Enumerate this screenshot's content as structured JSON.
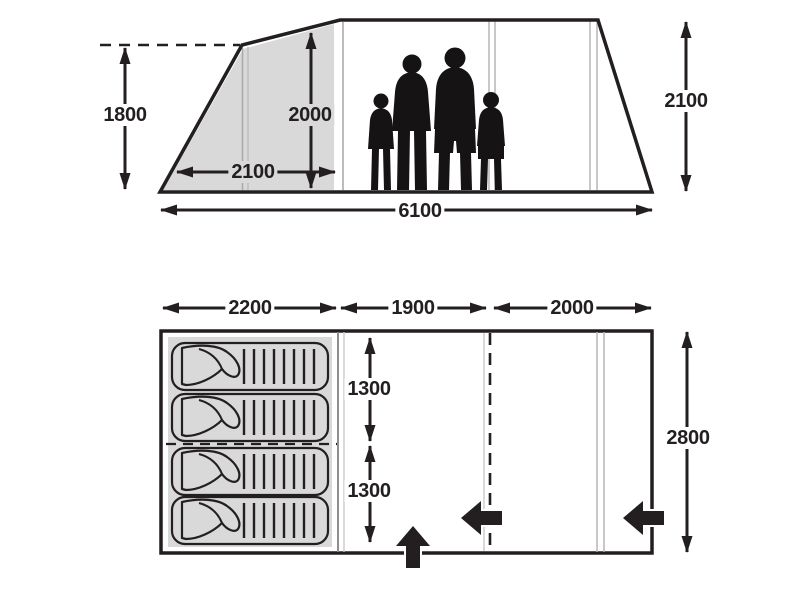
{
  "diagram_type": "tent-dimension-specification",
  "colors": {
    "ink": "#231f20",
    "panel_gray": "#d9d9d9",
    "divider_gray": "#b5b5b5",
    "background": "#ffffff"
  },
  "elevation": {
    "name": "side-elevation-view",
    "dimensions": {
      "front_peak_height_mm": "1800",
      "bedroom_inner_height_mm": "2000",
      "bedroom_length_mm": "2100",
      "total_length_mm": "6100",
      "max_height_mm": "2100"
    },
    "icons": [
      "family-scale-silhouette",
      "pole-divider-lines",
      "peak-height-dashed-line"
    ]
  },
  "floor_plan": {
    "name": "floor-plan-view",
    "dimensions": {
      "bedroom_section_mm": "2200",
      "living_section_mm": "1900",
      "front_section_mm": "2000",
      "bedroom_half_depth_upper_mm": "1300",
      "bedroom_half_depth_lower_mm": "1300",
      "total_depth_mm": "2800"
    },
    "sleeping_bag_count": 4,
    "icons": [
      "sleeping-bag-icon",
      "entrance-arrow-front",
      "entrance-arrow-middle-door",
      "entrance-arrow-side-door",
      "door-dashed-line",
      "bedroom-center-dashed-line"
    ]
  }
}
